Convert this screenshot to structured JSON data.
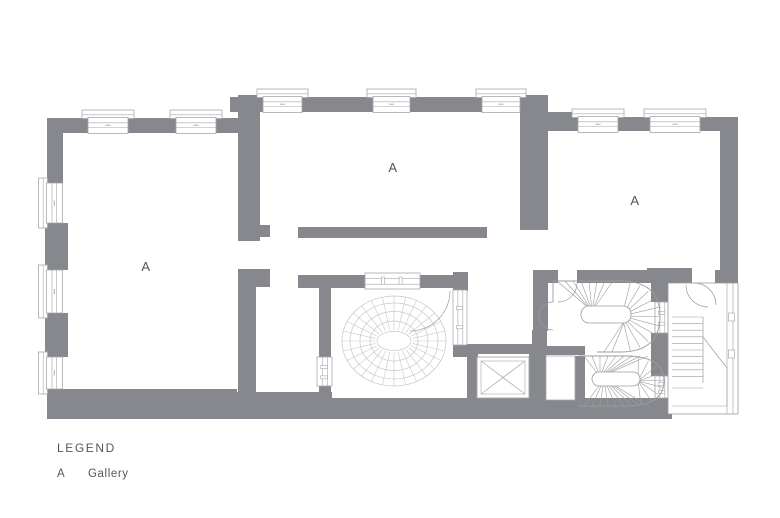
{
  "colors": {
    "wall": "#87888d",
    "window_line": "#a6a7ab",
    "fine_line": "#c6c7ca",
    "stair_line": "#9b9ca0",
    "text": "#55565a",
    "background": "#ffffff"
  },
  "floor_plan": {
    "type": "architectural-plan",
    "rooms": [
      {
        "name": "gallery-west",
        "label": "A"
      },
      {
        "name": "gallery-central",
        "label": "A"
      },
      {
        "name": "gallery-east",
        "label": "A"
      }
    ],
    "elements": [
      "exterior-walls",
      "window-bays",
      "oval-dome-skylight",
      "grand-oval-staircase",
      "secondary-staircase",
      "fire-stair",
      "elevator-shaft",
      "door-swings"
    ]
  },
  "legend": {
    "title": "LEGEND",
    "entries": [
      {
        "key": "A",
        "label": "Gallery"
      }
    ]
  }
}
